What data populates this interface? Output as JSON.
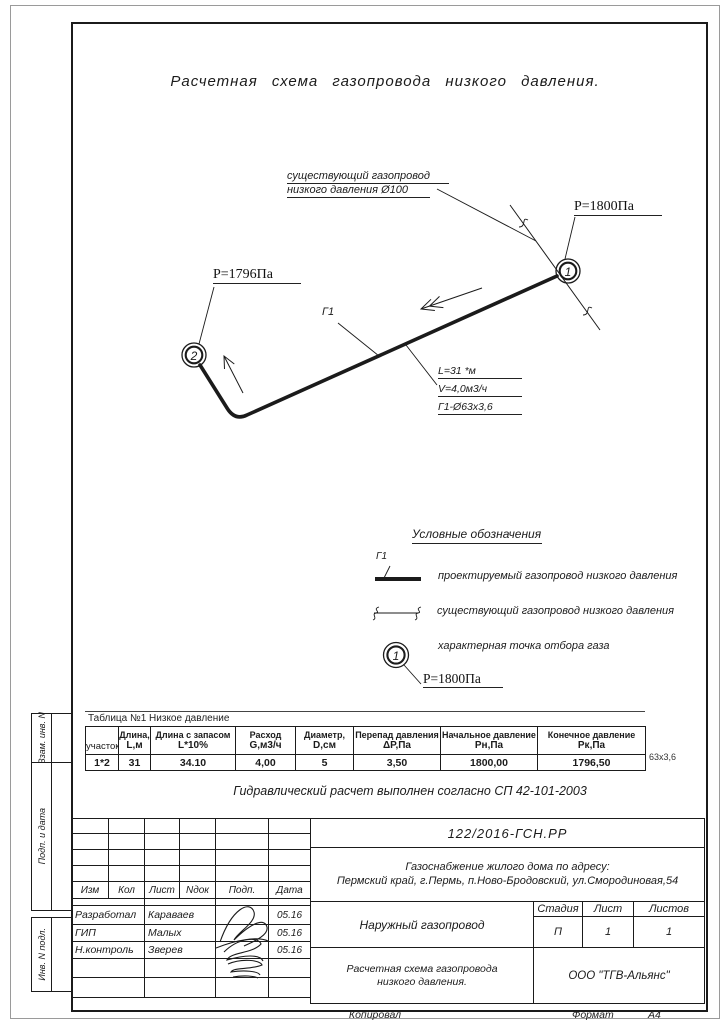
{
  "accent_colors": {
    "ink": "#1b1b1b",
    "paper": "#ffffff"
  },
  "page": {
    "title": "Расчетная  схема  газопровода  низкого  давления.",
    "note": "Гидравлический расчет выполнен согласно СП 42-101-2003",
    "copied_label": "Копировал",
    "format_label": "Формат",
    "format_value": "А4"
  },
  "scheme": {
    "existing_label_line1": "существующий газопровод",
    "existing_label_line2": "низкого давления Ø100",
    "pressure_start": "Р=1800Па",
    "pressure_end": "Р=1796Па",
    "node1": "1",
    "node2": "2",
    "segment_label": "Г1",
    "dim_line1": "L=31 *м",
    "dim_line2": "V=4,0м3/ч",
    "dim_line3": "Г1-Ø63х3,6"
  },
  "legend": {
    "title": "Условные обозначения",
    "flag": "Г1",
    "item_proposed": "проектируемый газопровод низкого давления",
    "item_existing": "существующий газопровод низкого давления",
    "item_node": "характерная точка отбора газа",
    "node_symbol": "1",
    "node_pressure": "Р=1800Па"
  },
  "table": {
    "caption": "Таблица №1  Низкое давление",
    "side_note": "63х3,6",
    "columns": [
      {
        "l1": "",
        "l2": "участок"
      },
      {
        "l1": "Длина,",
        "l2": "L,м"
      },
      {
        "l1": "Длина с запасом",
        "l2": "L*10%"
      },
      {
        "l1": "Расход",
        "l2": "G,м3/ч"
      },
      {
        "l1": "Диаметр,",
        "l2": "D,см"
      },
      {
        "l1": "Перепад давления",
        "l2": "ΔР,Па"
      },
      {
        "l1": "Начальное давление",
        "l2": "Рн,Па"
      },
      {
        "l1": "Конечное давление",
        "l2": "Рк,Па"
      }
    ],
    "row": [
      "1*2",
      "31",
      "34.10",
      "4,00",
      "5",
      "3,50",
      "1800,00",
      "1796,50"
    ]
  },
  "titleblock": {
    "doc_number": "122/2016-ГСН.РР",
    "project_line1": "Газоснабжение жилого дома по адресу:",
    "project_line2": "Пермский край,  г.Пермь,  п.Ново-Бродовский,  ул.Смородиновая,54",
    "object_name": "Наружный газопровод",
    "stage_label": "Стадия",
    "sheet_label": "Лист",
    "sheets_label": "Листов",
    "stage": "П",
    "sheet": "1",
    "sheets": "1",
    "sheet_title_line1": "Расчетная схема газопровода",
    "sheet_title_line2": "низкого давления.",
    "company": "ООО \"ТГВ-Альянс\"",
    "rev_headers": [
      "Изм",
      "Кол",
      "Лист",
      "Nдок",
      "Подп.",
      "Дата"
    ],
    "rows": [
      {
        "role": "Разработал",
        "name": "Караваев",
        "date": "05.16"
      },
      {
        "role": "ГИП",
        "name": "Малых",
        "date": "05.16"
      },
      {
        "role": "Н.контроль",
        "name": "Зверев",
        "date": "05.16"
      }
    ]
  },
  "sidebar": {
    "label1": "Взам. инв. N",
    "label2": "Подп. и дата",
    "label3": "Инв. N подл."
  }
}
